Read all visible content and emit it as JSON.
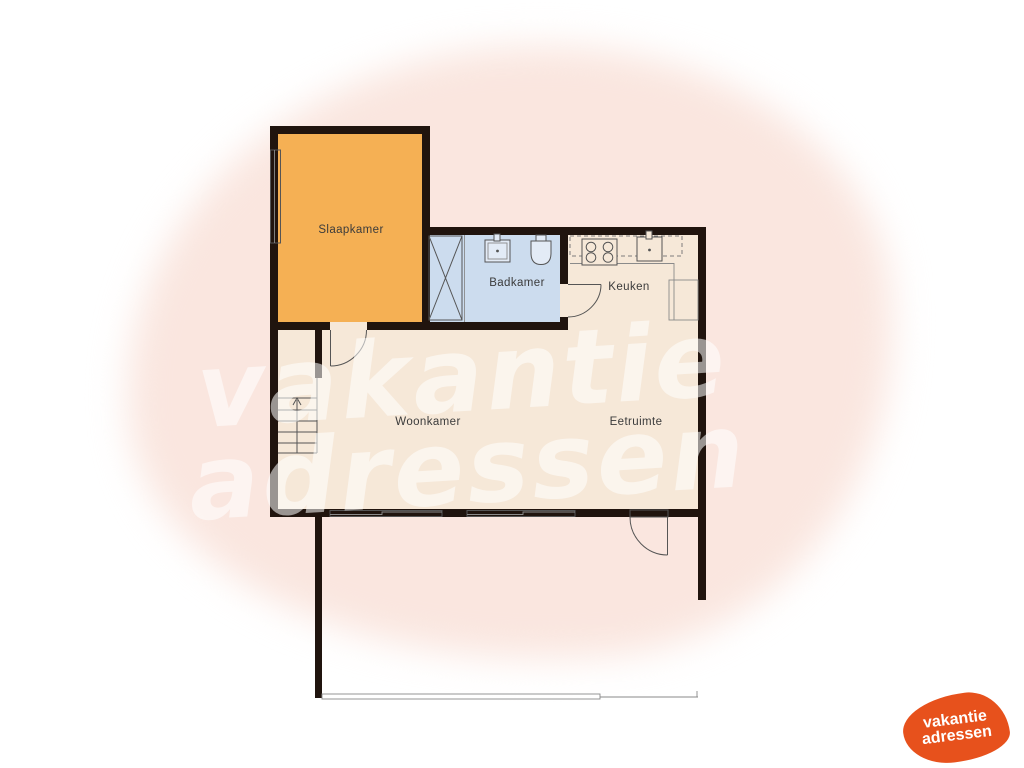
{
  "title": "floorplan",
  "rooms": {
    "slaapkamer": {
      "label": "Slaapkamer",
      "fill": "#f5b054"
    },
    "badkamer": {
      "label": "Badkamer",
      "fill": "#ccdcee"
    },
    "keuken": {
      "label": "Keuken",
      "fill": "#f6e8d8"
    },
    "woonkamer": {
      "label": "Woonkamer",
      "fill": "#f6e8d8"
    },
    "eetruimte": {
      "label": "Eetruimte",
      "fill": "#f6e8d8"
    }
  },
  "fixtures": [
    "shower",
    "washbasin",
    "toilet",
    "stove",
    "kitchen-sink",
    "kitchen-counter",
    "cabinet",
    "staircase",
    "stairs-up-arrow",
    "interior-door",
    "exterior-door",
    "window",
    "terrace-edge"
  ],
  "colors": {
    "wall": "#20140e",
    "line": "#555555",
    "background_blob": "#fae6df",
    "watermark_text": "rgba(255,255,255,0.55)",
    "logo_background": "#e7511c",
    "logo_text": "#ffffff"
  },
  "watermark": {
    "line1": "vakantie",
    "line2": "adressen"
  },
  "logo": {
    "line1": "vakantie",
    "line2": "adressen"
  }
}
